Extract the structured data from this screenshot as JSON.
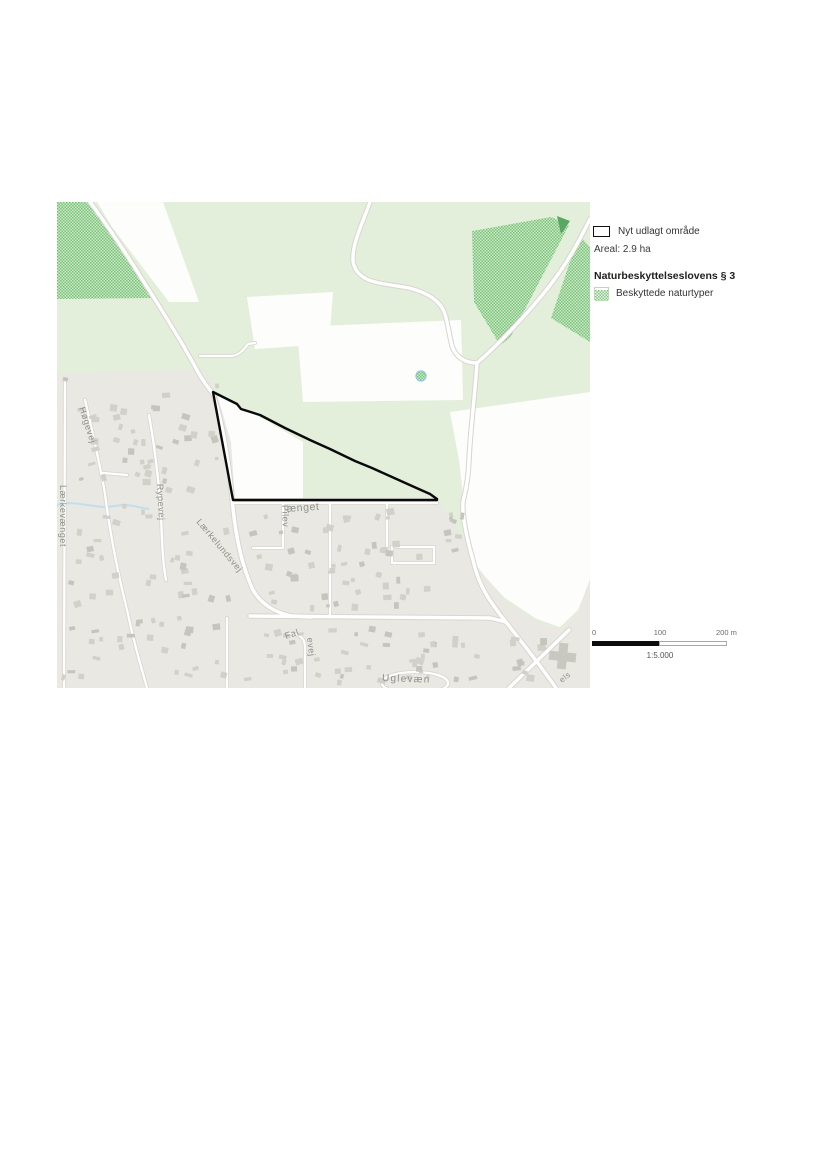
{
  "page": {
    "type": "plan-document-map-figure"
  },
  "map": {
    "streets": {
      "hogevej": "Høgevej",
      "rypevej": "Rypevej",
      "laerkelundsvej": "Lærkelundsvej",
      "laerkevaenget": "Lærkevænget",
      "pilevaenget_vertical": "Pilev",
      "pilevaenget_horizontal": "ænget",
      "falkevej_start": "Fal",
      "falkevej_vertical": "evej",
      "uglevaenget": "Uglevæn",
      "corner_label": "els"
    },
    "colors": {
      "background_green": "#e3efdb",
      "field_white": "#fdfdfc",
      "town_grey": "#e9e8e3",
      "building_grey": "#d1d0c9",
      "protected_hatch_green": "#79c27b",
      "road_casing": "#d8d7d1",
      "stream_blue": "#bfdfee",
      "outline_black": "#0a0a0a",
      "label_grey": "#8f8f89"
    }
  },
  "legend": {
    "new_area": {
      "label": "Nyt udlagt område",
      "swatch": "black-outline-rectangle"
    },
    "area_text": "Areal: 2.9 ha",
    "section_heading": "Naturbeskyttelseslovens § 3",
    "protected": {
      "label": "Beskyttede naturtyper",
      "swatch": "green-hatch-square"
    }
  },
  "scalebar": {
    "tick_start": "0",
    "tick_mid": "100",
    "tick_end": "200 m",
    "scale_ratio": "1:5.000"
  }
}
